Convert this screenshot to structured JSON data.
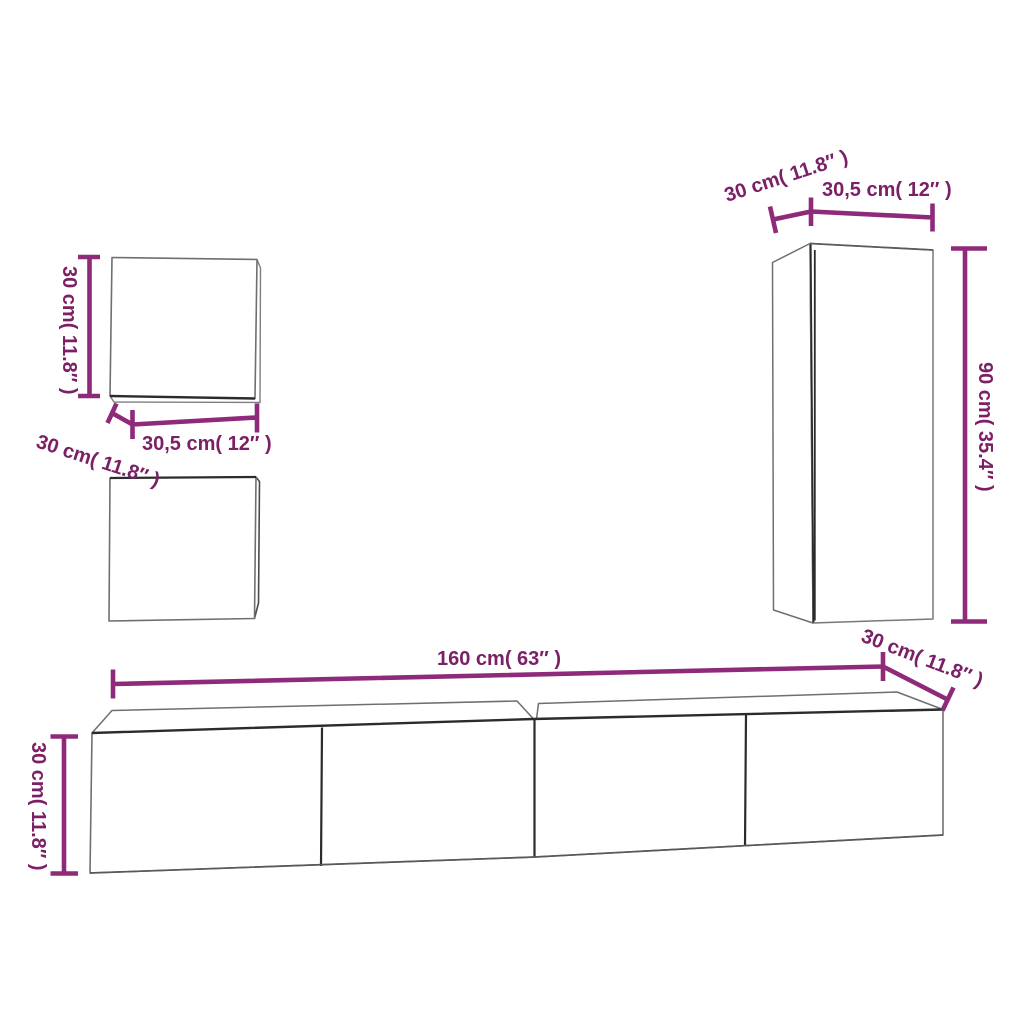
{
  "colors": {
    "dimension_line": "#8E2A79",
    "dimension_text": "#7C2066",
    "outline_light": "#6e6f72",
    "outline_dark": "#2b2b2d",
    "background": "#ffffff"
  },
  "dimensions": {
    "small_cabinet": {
      "height": "30 cm( 11.8″ )",
      "width": "30,5 cm( 12″ )",
      "depth": "30 cm( 11.8″ )"
    },
    "tall_cabinet": {
      "depth": "30 cm( 11.8″ )",
      "width": "30,5 cm( 12″ )",
      "height": "90 cm( 35.4″ )"
    },
    "long_cabinet": {
      "width": "160 cm( 63″ )",
      "depth": "30 cm( 11.8″ )",
      "height": "30 cm( 11.8″ )"
    }
  }
}
